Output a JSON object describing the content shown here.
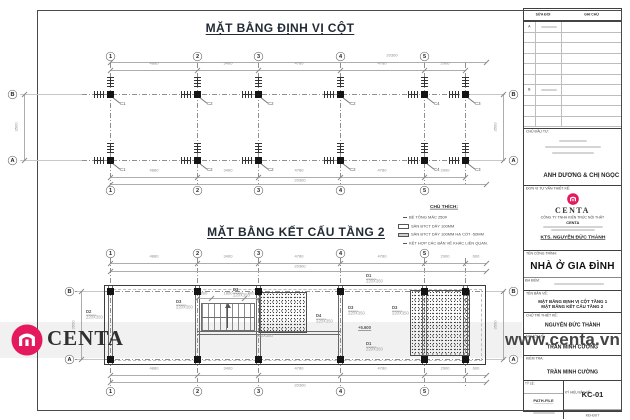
{
  "sheet": {
    "bg": "#ffffff",
    "frame_color": "#4a4a4a"
  },
  "plans": {
    "top": {
      "title": "MẶT BẰNG ĐỊNH VỊ CỘT",
      "grids": [
        "1",
        "2",
        "3",
        "4",
        "5"
      ],
      "grid_x": [
        110,
        197,
        258,
        340,
        424
      ],
      "extra_col_x": 465,
      "right_edge_x": 486,
      "rows": [
        "B",
        "A"
      ],
      "row_y": [
        94,
        160
      ],
      "span_dims": [
        "4880",
        "3400",
        "4780",
        "4780",
        "2900"
      ],
      "overall_dim": "20300",
      "side_dim": "3500",
      "columns_row_b": [
        "C1",
        "C2",
        "C2",
        "C2",
        "C4",
        "C3"
      ],
      "columns_row_a": [
        "C1",
        "C2",
        "C2",
        "C2",
        "C4",
        "C3"
      ]
    },
    "bottom": {
      "title": "MẶT BẰNG KẾT CẤU TẦNG 2",
      "grids": [
        "1",
        "2",
        "3",
        "4",
        "5"
      ],
      "grid_x": [
        110,
        197,
        258,
        340,
        424
      ],
      "extra_col_x": 465,
      "right_edge_x": 486,
      "rows": [
        "B",
        "A"
      ],
      "row_y": [
        291,
        359
      ],
      "span_dims": [
        "4880",
        "3400",
        "4780",
        "4780",
        "2900"
      ],
      "end_dim": "600",
      "overall_dim": "20300",
      "side_dim": "3500",
      "stair_dims": [
        "800",
        "1800",
        "800"
      ],
      "level_mark": "+5.600",
      "beams": [
        {
          "name": "D2",
          "size": "220X350",
          "x": 86,
          "y": 310
        },
        {
          "name": "D3",
          "size": "220X350",
          "x": 176,
          "y": 300
        },
        {
          "name": "D3",
          "size": "220X350",
          "x": 233,
          "y": 288
        },
        {
          "name": "",
          "size": "150X350",
          "x": 256,
          "y": 334
        },
        {
          "name": "D4",
          "size": "220X350",
          "x": 316,
          "y": 314
        },
        {
          "name": "D3",
          "size": "220X350",
          "x": 348,
          "y": 306
        },
        {
          "name": "D3",
          "size": "220X350",
          "x": 392,
          "y": 306
        },
        {
          "name": "D1",
          "size": "220X350",
          "x": 366,
          "y": 274
        },
        {
          "name": "D1",
          "size": "220X350",
          "x": 366,
          "y": 342
        }
      ]
    }
  },
  "legend": {
    "heading": "CHÚ THÍCH:",
    "items": [
      {
        "swatch": "dash",
        "text": "BÊ TÔNG MÁC 250#"
      },
      {
        "swatch": "plain",
        "text": "SÀN BTCT DÀY 100MM"
      },
      {
        "swatch": "hatch",
        "text": "SÀN BTCT DÀY 100MM HẠ CỐT -50MM"
      },
      {
        "swatch": "dash",
        "text": "KẾT HỢP CÁC BẢN VẼ KHÁC LIÊN QUAN."
      }
    ]
  },
  "watermark": {
    "brand": "CENTA",
    "url": "www.centa.vn",
    "brand_color": "#e4195e"
  },
  "title_block": {
    "revision": {
      "headers": [
        "SỬA ĐỔI",
        "GHI CHÚ"
      ],
      "rows": [
        "A",
        "",
        "",
        "",
        "",
        "",
        "B",
        "",
        "",
        ""
      ]
    },
    "client": {
      "label": "CHỦ ĐẦU TƯ:",
      "name": "ANH DƯƠNG & CHỊ NGỌC"
    },
    "company": {
      "label": "ĐƠN VỊ TƯ VẤN THIẾT KẾ:",
      "brand": "CENTA",
      "line1": "CÔNG TY TNHH KIẾN TRÚC NỘI THẤT",
      "line2": "CENTA",
      "architect": "KTS. NGUYỄN ĐỨC THÀNH"
    },
    "project": {
      "label": "TÊN CÔNG TRÌNH:",
      "name": "NHÀ Ở GIA ĐÌNH",
      "loc_label": "ĐỊA ĐIỂM:"
    },
    "drawing": {
      "label": "TÊN BẢN VẼ:",
      "line1": "MẶT BẰNG ĐỊNH VỊ CỘT TẦNG 1",
      "line2": "MẶT BẰNG KẾT CẤU TẦNG 2"
    },
    "people": [
      {
        "label": "CHỦ TRÌ THIẾT KẾ:",
        "name": "NGUYỄN ĐỨC THÀNH"
      },
      {
        "label": "NGƯỜI VẼ:",
        "name": "TRẦN MINH CƯỜNG"
      },
      {
        "label": "KIỂM TRA:",
        "name": "TRẦN MINH CƯỜNG"
      }
    ],
    "footer": {
      "scale_label": "TỶ LỆ:",
      "path_label": "PATH-FILE",
      "code_label": "KÝ HIỆU BẢN VẼ:",
      "code": "KC-01",
      "sheet": "KĐ-Đ07"
    }
  }
}
